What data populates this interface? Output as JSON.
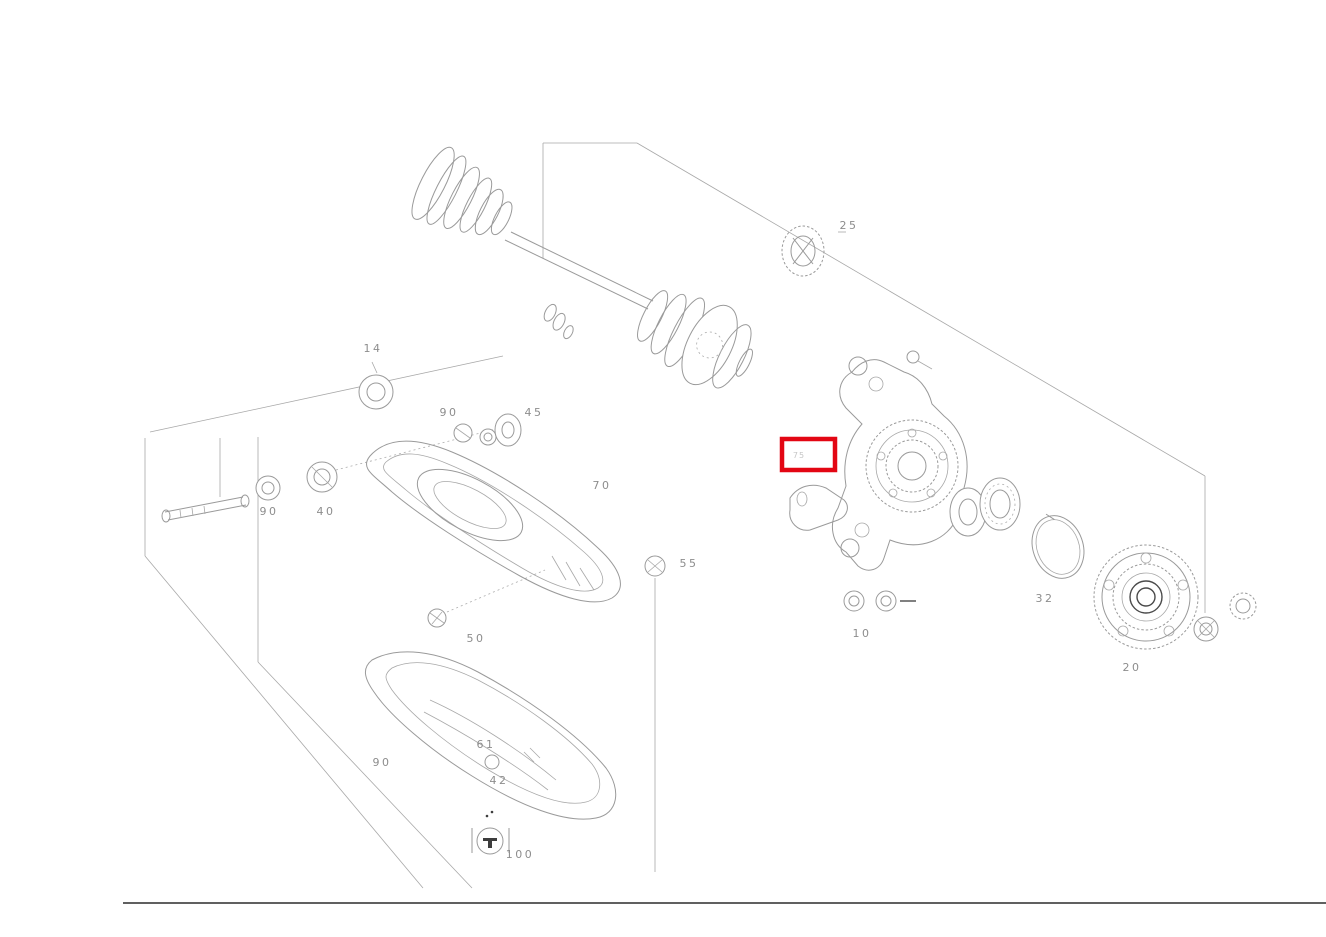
{
  "diagram": {
    "type": "exploded-parts-diagram",
    "subject": "rear axle drive shaft, wheel carrier and hub assembly",
    "colors": {
      "background": "#ffffff",
      "line": "#9a9a9a",
      "label": "#8d8d8d",
      "highlight": "#e30613",
      "frame": "#000000"
    },
    "highlight": {
      "x": 782,
      "y": 439,
      "width": 53,
      "height": 31,
      "stroke_width": 4.5,
      "color": "#e30613",
      "label": "75"
    },
    "callouts": [
      {
        "label": "25",
        "x": 849,
        "y": 229,
        "faint": false
      },
      {
        "label": "14",
        "x": 373,
        "y": 352,
        "faint": false
      },
      {
        "label": "90",
        "x": 449,
        "y": 416,
        "faint": false
      },
      {
        "label": "45",
        "x": 534,
        "y": 416,
        "faint": false
      },
      {
        "label": "90",
        "x": 269,
        "y": 515,
        "faint": false
      },
      {
        "label": "40",
        "x": 326,
        "y": 515,
        "faint": false
      },
      {
        "label": "70",
        "x": 602,
        "y": 489,
        "faint": false
      },
      {
        "label": "55",
        "x": 689,
        "y": 567,
        "faint": false
      },
      {
        "label": "50",
        "x": 476,
        "y": 642,
        "faint": false
      },
      {
        "label": "10",
        "x": 862,
        "y": 637,
        "faint": false
      },
      {
        "label": "32",
        "x": 1045,
        "y": 602,
        "faint": false
      },
      {
        "label": "20",
        "x": 1132,
        "y": 671,
        "faint": false
      },
      {
        "label": "90",
        "x": 382,
        "y": 766,
        "faint": false
      },
      {
        "label": "61",
        "x": 486,
        "y": 748,
        "faint": false
      },
      {
        "label": "42",
        "x": 499,
        "y": 784,
        "faint": false
      },
      {
        "label": "100",
        "x": 520,
        "y": 858,
        "faint": false
      },
      {
        "label": "75",
        "x": 799,
        "y": 458,
        "faint": true
      }
    ]
  }
}
